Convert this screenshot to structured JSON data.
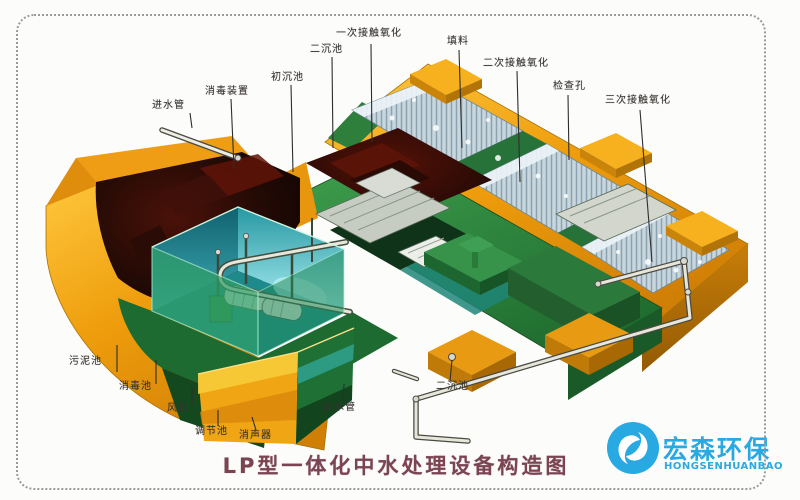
{
  "page": {
    "background": "#FCFCFB",
    "border_color": "#9a9a9a"
  },
  "diagram": {
    "title": "LP型一体化中水处理设备构造图",
    "title_color": "#7A4453",
    "labels": [
      {
        "text": "一次接触氧化"
      },
      {
        "text": "二沉池"
      },
      {
        "text": "填料"
      },
      {
        "text": "二次接触氧化"
      },
      {
        "text": "检查孔"
      },
      {
        "text": "三次接触氧化"
      },
      {
        "text": "进水管"
      },
      {
        "text": "消毒装置"
      },
      {
        "text": "初沉池"
      },
      {
        "text": "污泥池"
      },
      {
        "text": "消毒池"
      },
      {
        "text": "风机"
      },
      {
        "text": "调节池"
      },
      {
        "text": "消声器"
      },
      {
        "text": "出水管"
      },
      {
        "text": "二沉池"
      }
    ],
    "colors": {
      "shell_orange": "#EE9D0C",
      "tank_green": "#2E8040",
      "water_teal": "#2FA8A0",
      "sludge_dark": "#2A0C06",
      "filter_media": "#C8D6DE",
      "pipe_silver": "#E6E6DA"
    }
  },
  "logo": {
    "name_cn": "宏森环保",
    "name_en": "HONGSENHUANBAO",
    "brand_color": "#29A9E2"
  }
}
